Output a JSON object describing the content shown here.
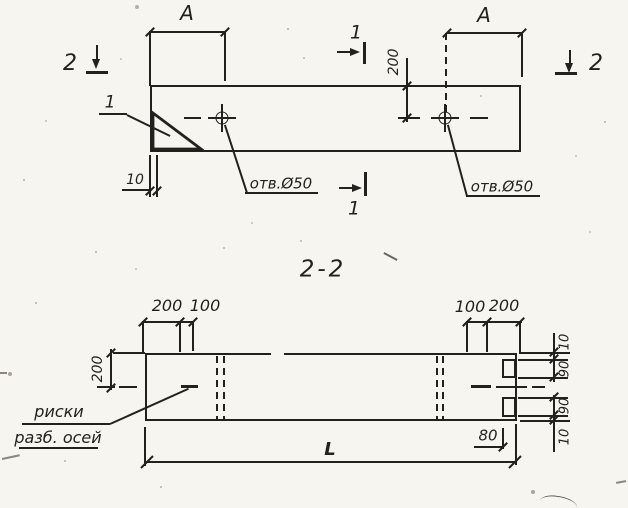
{
  "colors": {
    "paper": "#f6f5f0",
    "ink": "#23211e"
  },
  "plan_view": {
    "section_marker_2_left": "2",
    "section_marker_2_right": "2",
    "section_marker_1_top": "1",
    "section_marker_1_bottom": "1",
    "dim_A_left": "A",
    "dim_A_right": "A",
    "dim_200": "200",
    "dim_10": "10",
    "detail_callout_1": "1",
    "hole_label_left": "отв.Ø50",
    "hole_label_right": "отв.Ø50"
  },
  "section_view": {
    "title": "2-2",
    "dims_top_left": [
      "200",
      "100"
    ],
    "dims_top_right": [
      "100",
      "200"
    ],
    "dim_left_200": "200",
    "dims_right": [
      "10",
      "90",
      "90",
      "10"
    ],
    "dim_80": "80",
    "dim_length": "L",
    "axes_label_line1": "риски",
    "axes_label_line2": "разб. осей"
  }
}
